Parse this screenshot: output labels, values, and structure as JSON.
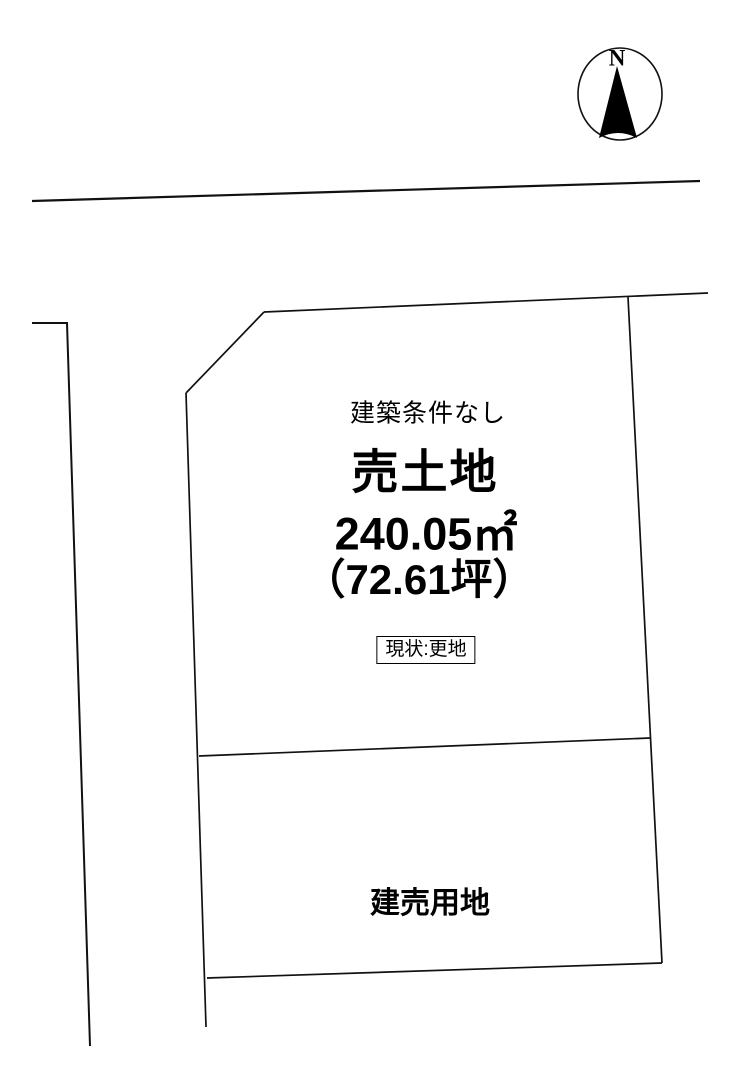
{
  "diagram_title": "土地区画図",
  "compass": {
    "label": "N",
    "direction": "north-up"
  },
  "parcel": {
    "condition": "建築条件なし",
    "title": "売土地",
    "area_sqm": "240.05㎡",
    "area_tsubo": "（72.61坪）",
    "status": "現状:更地"
  },
  "lower_parcel": {
    "label": "建売用地"
  },
  "colors": {
    "line": "#111111",
    "background": "#ffffff",
    "text": "#000000"
  }
}
